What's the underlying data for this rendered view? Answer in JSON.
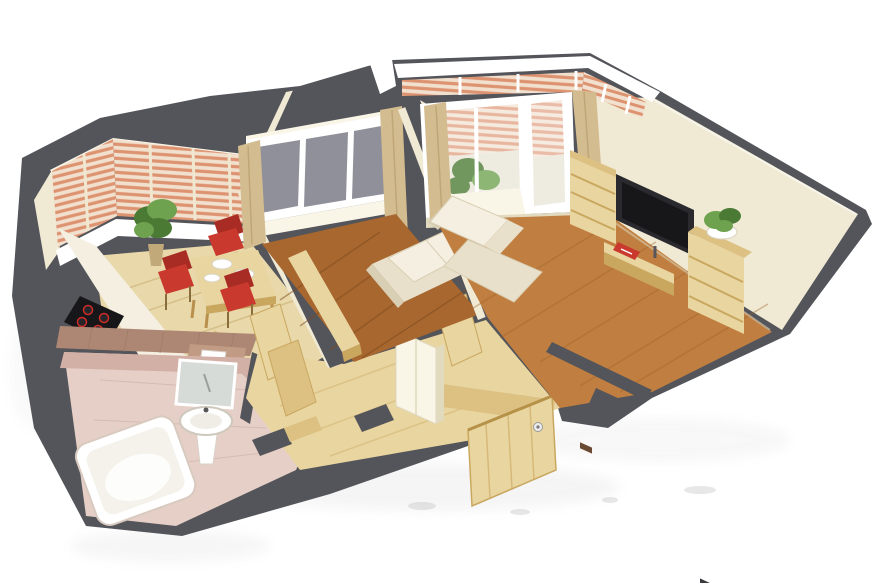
{
  "scene": {
    "label": "isometric-3d-apartment-floorplan-render",
    "type": "3d-floorplan",
    "rooms": [
      {
        "name": "kitchen",
        "items": [
          "bay-window-blinds",
          "window-sill",
          "kitchen-counter",
          "cooktop-4-burners",
          "potted-plant",
          "dining-table",
          "plates",
          "red-chair",
          "red-chair",
          "red-chair",
          "tall-cabinet"
        ]
      },
      {
        "name": "bedroom",
        "items": [
          "window-gray-panes",
          "curtain-left",
          "curtain-right",
          "window-sill",
          "loveseat-sofa",
          "wood-sideboard",
          "dark-wood-floor"
        ]
      },
      {
        "name": "living-room",
        "items": [
          "balcony-blinds",
          "balcony-glass-door",
          "balcony-window",
          "balcony-plant",
          "balcony-bench",
          "curtain-left",
          "curtain-right",
          "corner-sofa",
          "wall-tv",
          "bookshelf-left",
          "bookshelf-right",
          "tv-console",
          "red-magazine",
          "plant-on-shelf",
          "wood-floor"
        ]
      },
      {
        "name": "bathroom",
        "items": [
          "pink-tile-floor",
          "tiled-wall",
          "bathtub",
          "pedestal-sink",
          "mirror",
          "toilet"
        ]
      },
      {
        "name": "hallway",
        "items": [
          "light-wood-floor",
          "open-door",
          "open-door",
          "open-door",
          "white-wardrobe",
          "entry-threshold",
          "front-door-open",
          "door-handle"
        ]
      }
    ]
  },
  "palette": {
    "wall_gray": "#54555a",
    "cream": "#f0ead4",
    "cream_light": "#f9f5e7",
    "cream_dark": "#e2dabe",
    "white": "#ffffff",
    "wood_light": "#e9d5a0",
    "wood_mid": "#dcc183",
    "wood_dark": "#c9a75f",
    "kitchen_floor": "#e8d8aa",
    "bedroom_floor": "#a8672f",
    "living_floor": "#c07f40",
    "glass_gray": "#90909a",
    "curtain_tan": "#d3bc90",
    "curtain_tan_dark": "#c2a97a",
    "chair_red": "#c9392e",
    "chair_red_dark": "#a92c24",
    "sofa_beige": "#e8e0ca",
    "sofa_beige_light": "#f4efe1",
    "tv_black": "#17171a",
    "bath_pink": "#e5cfc7",
    "bath_pink_dark": "#d2b0a5",
    "tile_brown": "#ad8773",
    "tile_brown_light": "#c29b85",
    "plant_green": "#4a7a33",
    "plant_green_light": "#6ea24e",
    "blind_base": "#f1e0ce",
    "blind_stripe": "#dd9270"
  }
}
